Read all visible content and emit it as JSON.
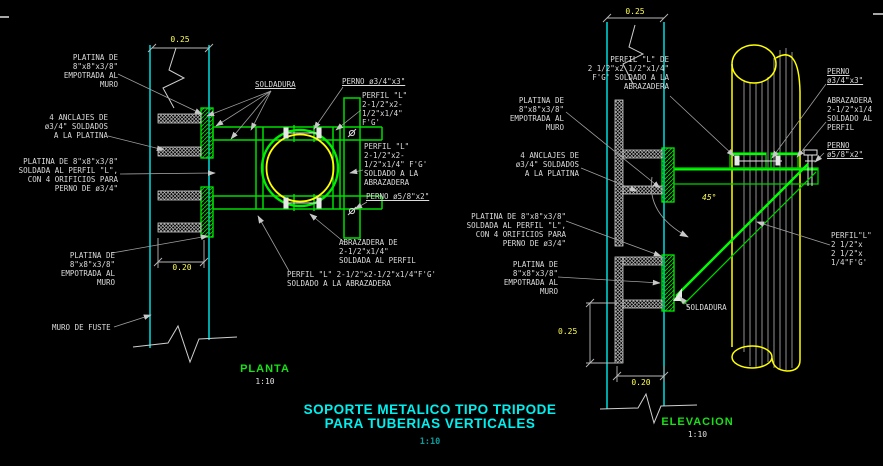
{
  "title": {
    "line1": "SOPORTE METALICO TIPO TRIPODE",
    "line2": "PARA TUBERIAS VERTICALES",
    "scale": "1:10"
  },
  "colors": {
    "cad_green": "#00ee00",
    "cad_cyan": "#00ffff",
    "cad_yellow": "#ffff00",
    "dim_yellow": "#fdfd54",
    "leader_gray": "#a0a0a0",
    "text_white": "#dcdcdc",
    "title_cyan": "#00f0f0"
  },
  "plan": {
    "view_label": "PLANTA",
    "view_scale": "1:10",
    "dims": {
      "width_top": "0.25",
      "width_bottom": "0.20"
    },
    "labels": {
      "platina_top": "PLATINA DE\n8\"x8\"x3/8\"\nEMPOTRADA AL\nMURO",
      "anclajes": "4 ANCLAJES DE\nø3/4\" SOLDADOS\nA LA PLATINA",
      "platina_soldada": "PLATINA DE 8\"x8\"x3/8\"\nSOLDADA AL PERFIL \"L\",\nCON 4 ORIFICIOS PARA\nPERNO DE ø3/4\"",
      "platina_bottom": "PLATINA DE\n8\"x8\"x3/8\"\nEMPOTRADA AL\nMURO",
      "muro_fuste": "MURO DE FUSTE",
      "soldadura": "SOLDADURA",
      "perno34": "PERNO ø3/4\"x3\"",
      "perfil_top": "PERFIL \"L\"\n2-1/2\"x2-\n1/2\"x1/4\"\nF'G'",
      "perfil_soldado": "PERFIL \"L\"\n2-1/2\"x2-\n1/2\"x1/4\" F'G'\nSOLDADO A LA\nABRAZADERA",
      "perno58": "PERNO ø5/8\"x2\"",
      "abrazadera": "ABRAZADERA DE\n2-1/2\"x1/4\"\nSOLDADA AL PERFIL",
      "perfil_bottom": "PERFIL \"L\" 2-1/2\"x2-1/2\"x1/4\"F'G'\nSOLDADO A LA ABRAZADERA"
    }
  },
  "elevation": {
    "view_label": "ELEVACION",
    "view_scale": "1:10",
    "dims": {
      "width_top": "0.25",
      "height_left": "0.25",
      "width_bottom": "0.20",
      "angle": "45°"
    },
    "labels": {
      "perfil_top": "PERFIL \"L\" DE\n2 1/2\"x2 1/2\"x1/4\"\nF'G' SOLDADO A LA\nABRAZADERA",
      "perno34": "PERNO\nø3/4\"x3\"",
      "abrazadera": "ABRAZADERA\n2-1/2\"x1/4\nSOLDADO AL\nPERFIL",
      "perno58": "PERNO\nø5/8\"x2\"",
      "platina_top": "PLATINA DE\n8\"x8\"x3/8\"\nEMPOTRADA AL\nMURO",
      "anclajes": "4 ANCLAJES DE\nø3/4\" SOLDADOS\nA LA PLATINA",
      "platina_soldada": "PLATINA DE 8\"x8\"x3/8\"\nSOLDADA AL PERFIL \"L\",\nCON 4 ORIFICIOS PARA\nPERNO DE ø3/4\"",
      "perfil_brace": "PERFIL\"L\"\n2 1/2\"x\n2 1/2\"x\n1/4\"F'G'",
      "platina_bottom": "PLATINA DE\n8\"x8\"x3/8\"\nEMPOTRADA AL\nMURO",
      "soldadura": "SOLDADURA"
    }
  }
}
